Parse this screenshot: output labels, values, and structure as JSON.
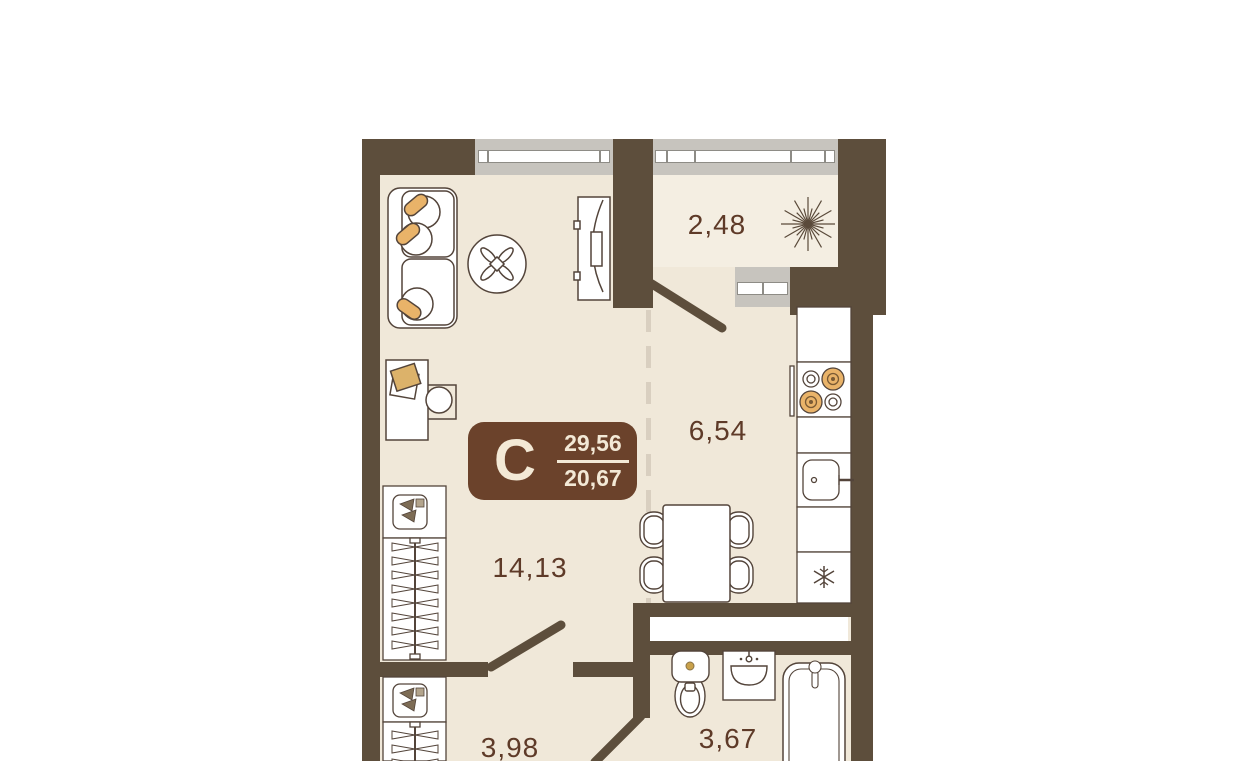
{
  "floor_plan": {
    "type_badge": {
      "letter": "C",
      "total_area": "29,56",
      "living_area": "20,67"
    },
    "rooms": [
      {
        "name": "balcony",
        "area": "2,48"
      },
      {
        "name": "kitchen",
        "area": "6,54"
      },
      {
        "name": "living-room",
        "area": "14,13"
      },
      {
        "name": "hallway",
        "area": "3,98"
      },
      {
        "name": "bathroom",
        "area": "3,67"
      }
    ],
    "colors": {
      "wall": "#5d4e3c",
      "floor": "#f0e8d9",
      "balcony_floor": "#f4eee2",
      "window_glazing": "#c7c4be",
      "accent_orange": "#e9b369",
      "badge_background": "#6b422b",
      "badge_text": "#f3e9d6",
      "room_label_text": "#5e3a28",
      "dashed_zone_divider": "#d9cfc0"
    },
    "furniture_symbols": [
      "sofa",
      "coffee-table",
      "tv",
      "desk",
      "desk-chair",
      "wardrobe",
      "hall-wardrobe",
      "plant",
      "stove",
      "kitchen-sink",
      "fridge",
      "dining-table",
      "dining-chairs",
      "toilet",
      "washbasin",
      "bathtub"
    ]
  }
}
